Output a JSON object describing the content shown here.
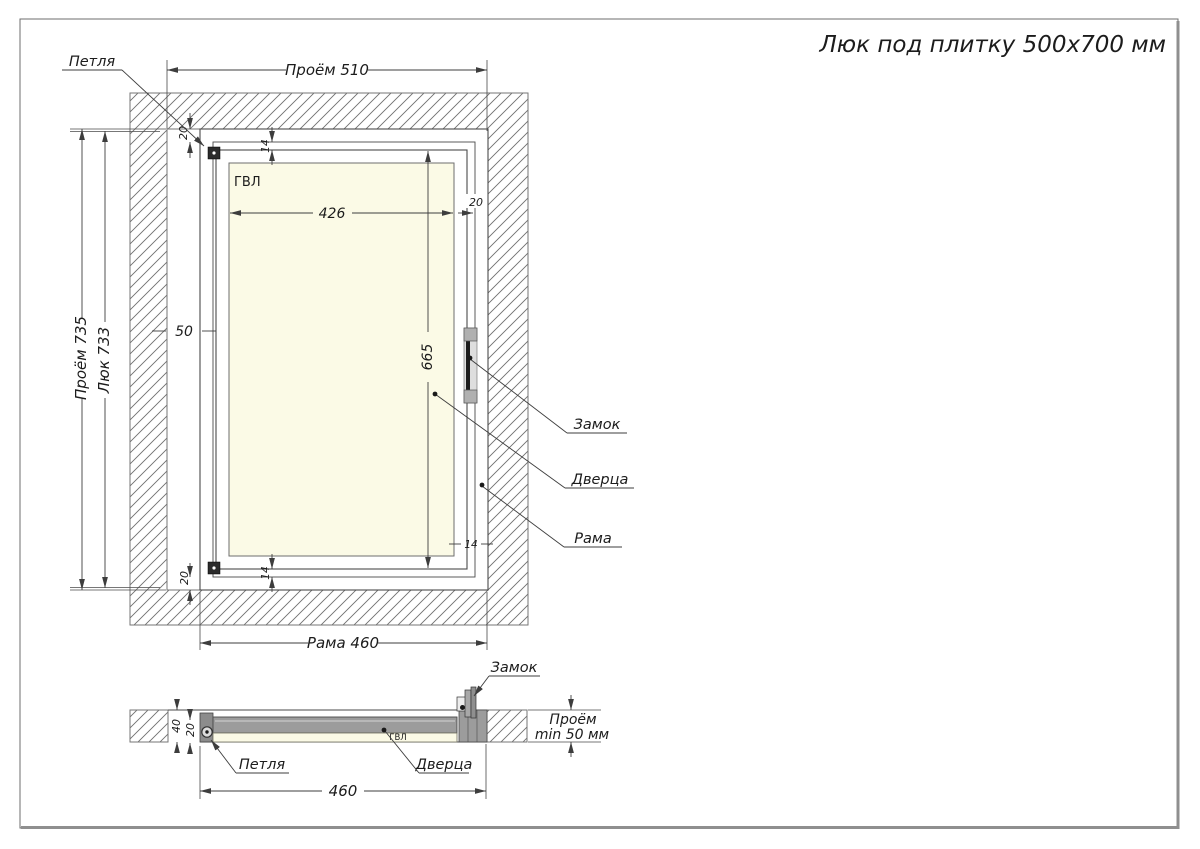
{
  "title": "Люк под плитку 500x700 мм",
  "front": {
    "hinge_label": "Петля",
    "lock_label": "Замок",
    "door_label": "Дверца",
    "frame_label": "Рама",
    "panel_label": "ГВЛ",
    "dim_opening_width": "Проём 510",
    "dim_opening_height": "Проём 735",
    "dim_hatch_height": "Люк 733",
    "dim_frame_width": "Рама 460",
    "dim_panel_width": "426",
    "dim_door_height": "665",
    "dim_hinge_gap": "50",
    "dim_profile_top": "20",
    "dim_profile_bottom": "20",
    "dim_profile_right": "20",
    "dim_gap_top": "14",
    "dim_gap_bottom": "14",
    "dim_gap_right": "14"
  },
  "section": {
    "lock_label": "Замок",
    "hinge_label": "Петля",
    "door_label": "Дверца",
    "panel_label": "ГВЛ",
    "dim_width": "460",
    "dim_depth_total": "40",
    "dim_depth_door": "20",
    "dim_opening_depth_1": "Проём",
    "dim_opening_depth_2": "min 50 мм"
  },
  "colors": {
    "frame_gray": "#9c9c9c",
    "panel_cream": "#fbfae6",
    "line_dark": "#3d3d3d",
    "hatch_line": "#6f6f6f",
    "page_border": "#8f8f8f"
  }
}
